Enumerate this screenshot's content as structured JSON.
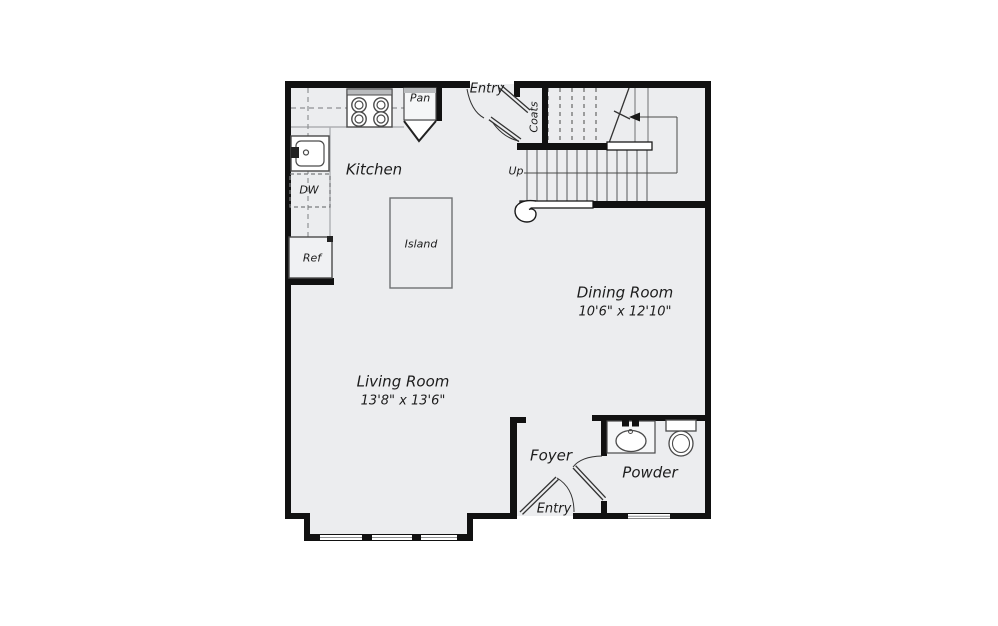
{
  "plan": {
    "title": "First floor plan",
    "colors": {
      "floor": "#ecedef",
      "wall": "#111111",
      "fixture_line": "#4a4a4a",
      "counter_dash": "#9a9a9a",
      "background": "#ffffff"
    },
    "rooms": {
      "kitchen": {
        "label": "Kitchen"
      },
      "island": {
        "label": "Island"
      },
      "dining": {
        "label": "Dining Room",
        "dimensions": "10'6\" x 12'10\""
      },
      "living": {
        "label": "Living Room",
        "dimensions": "13'8\" x 13'6\""
      },
      "foyer": {
        "label": "Foyer"
      },
      "powder": {
        "label": "Powder"
      },
      "coats": {
        "label": "Coats"
      },
      "pantry": {
        "label": "Pan"
      },
      "dishwasher": {
        "label": "DW"
      },
      "refrigerator": {
        "label": "Ref"
      },
      "entry_top": {
        "label": "Entry"
      },
      "entry_bottom": {
        "label": "Entry"
      },
      "stairs": {
        "label": "Up"
      }
    },
    "fixtures": [
      "stove-icon",
      "kitchen-sink-icon",
      "pantry-door",
      "island-counter",
      "stairs-up",
      "coats-closet",
      "entry-double-door",
      "bay-window",
      "powder-window",
      "vanity-sink-icon",
      "toilet-icon",
      "powder-door",
      "entry-door"
    ]
  }
}
